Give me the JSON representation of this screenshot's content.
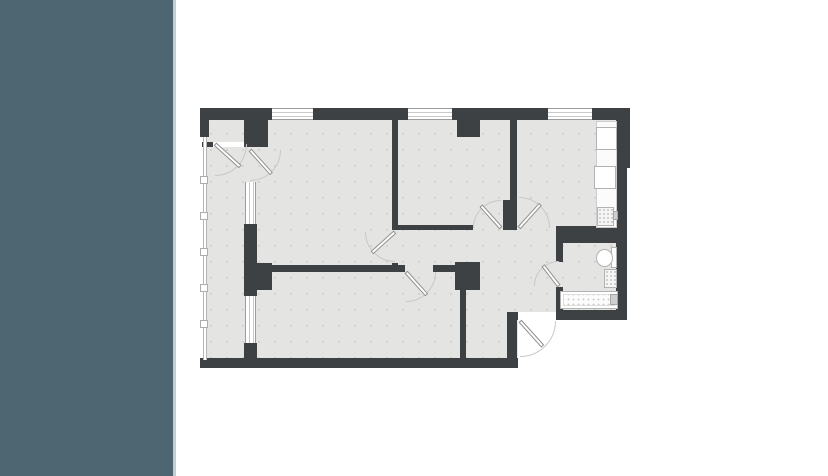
{
  "canvas": {
    "width": 828,
    "height": 476,
    "background": "#ffffff"
  },
  "left_panel": {
    "color": "#4d6671",
    "edge_color": "#c4ced2",
    "width": 173,
    "edge_width": 3
  },
  "palette": {
    "wall": "#3e4144",
    "floor": "#e4e4e3",
    "floor_dot": "#d0d0cf",
    "outside": "#ffffff",
    "window_frame": "#9c9c9c",
    "door_arc": "#c8c8c8",
    "door_leaf_border": "#8f8f8f",
    "fixture_border": "#b2b2b2"
  },
  "plan": {
    "floors": [
      {
        "n": "floor-base",
        "x": 203,
        "y": 110,
        "w": 423,
        "h": 250
      }
    ],
    "outside": [
      {
        "n": "outside-entry-area",
        "x": 518,
        "y": 320,
        "w": 114,
        "h": 50
      },
      {
        "n": "outside-right-step",
        "x": 627,
        "y": 166,
        "w": 6,
        "h": 154
      }
    ],
    "walls": [
      {
        "n": "wall-top-1",
        "x": 201,
        "y": 108,
        "w": 71,
        "h": 12
      },
      {
        "n": "wall-top-2",
        "x": 313,
        "y": 108,
        "w": 95,
        "h": 12
      },
      {
        "n": "wall-top-3",
        "x": 452,
        "y": 108,
        "w": 96,
        "h": 12
      },
      {
        "n": "wall-top-4",
        "x": 592,
        "y": 108,
        "w": 36,
        "h": 12
      },
      {
        "n": "wall-left-column",
        "x": 200,
        "y": 108,
        "w": 9,
        "h": 29
      },
      {
        "n": "wall-corner-block",
        "x": 244,
        "y": 108,
        "w": 24,
        "h": 39
      },
      {
        "n": "wall-niche-sill",
        "x": 202,
        "y": 142,
        "w": 12,
        "h": 5
      },
      {
        "n": "wall-bedroom1-column",
        "x": 457,
        "y": 120,
        "w": 23,
        "h": 17
      },
      {
        "n": "wall-right-upper",
        "x": 616,
        "y": 108,
        "w": 14,
        "h": 60
      },
      {
        "n": "wall-right-lower",
        "x": 616,
        "y": 168,
        "w": 11,
        "h": 152
      },
      {
        "n": "wall-living-bedroom1",
        "x": 392,
        "y": 120,
        "w": 6,
        "h": 110
      },
      {
        "n": "wall-living-stub",
        "x": 392,
        "y": 263,
        "w": 6,
        "h": 9
      },
      {
        "n": "wall-bedroom1-kitchen",
        "x": 510,
        "y": 120,
        "w": 7,
        "h": 82
      },
      {
        "n": "wall-kitchen-pillar",
        "x": 503,
        "y": 200,
        "w": 14,
        "h": 30
      },
      {
        "n": "wall-bedroom1-south",
        "x": 398,
        "y": 225,
        "w": 75,
        "h": 5
      },
      {
        "n": "wall-bath-north",
        "x": 556,
        "y": 226,
        "w": 62,
        "h": 17
      },
      {
        "n": "wall-bath-west-upper",
        "x": 556,
        "y": 243,
        "w": 7,
        "h": 19
      },
      {
        "n": "wall-bath-west-lower",
        "x": 556,
        "y": 287,
        "w": 7,
        "h": 25
      },
      {
        "n": "wall-bath-south",
        "x": 556,
        "y": 310,
        "w": 71,
        "h": 10
      },
      {
        "n": "wall-bedroom2-north-1",
        "x": 272,
        "y": 265,
        "w": 133,
        "h": 7
      },
      {
        "n": "wall-bedroom2-north-2",
        "x": 433,
        "y": 265,
        "w": 24,
        "h": 7
      },
      {
        "n": "wall-balcony-junction",
        "x": 244,
        "y": 263,
        "w": 28,
        "h": 27
      },
      {
        "n": "wall-hall-pillar",
        "x": 455,
        "y": 262,
        "w": 25,
        "h": 28
      },
      {
        "n": "wall-bedroom2-east",
        "x": 460,
        "y": 290,
        "w": 6,
        "h": 70
      },
      {
        "n": "wall-entry-north",
        "x": 507,
        "y": 312,
        "w": 11,
        "h": 8
      },
      {
        "n": "wall-entry-east",
        "x": 507,
        "y": 312,
        "w": 10,
        "h": 46
      },
      {
        "n": "wall-south",
        "x": 200,
        "y": 358,
        "w": 318,
        "h": 10
      },
      {
        "n": "wall-balcony-mid-1",
        "x": 244,
        "y": 224,
        "w": 13,
        "h": 39
      },
      {
        "n": "wall-balcony-mid-2",
        "x": 244,
        "y": 290,
        "w": 13,
        "h": 6
      },
      {
        "n": "wall-balcony-south",
        "x": 244,
        "y": 343,
        "w": 13,
        "h": 17
      }
    ],
    "windows": [
      {
        "n": "window-living",
        "o": "h",
        "x": 272,
        "y": 108,
        "w": 41,
        "h": 12
      },
      {
        "n": "window-bedroom-1",
        "o": "h",
        "x": 408,
        "y": 108,
        "w": 44,
        "h": 12
      },
      {
        "n": "window-kitchen",
        "o": "h",
        "x": 548,
        "y": 108,
        "w": 44,
        "h": 12
      },
      {
        "n": "window-balcony-upper",
        "o": "v",
        "x": 245,
        "y": 182,
        "w": 11,
        "h": 42
      },
      {
        "n": "window-balcony-lower",
        "o": "v",
        "x": 245,
        "y": 296,
        "w": 11,
        "h": 47
      }
    ],
    "railing": {
      "n": "balcony-railing",
      "x": 203,
      "y": 137,
      "w": 4,
      "h": 223,
      "post_size": 8,
      "posts": [
        {
          "x": 200,
          "y": 176
        },
        {
          "x": 200,
          "y": 212
        },
        {
          "x": 200,
          "y": 248
        },
        {
          "x": 200,
          "y": 284
        },
        {
          "x": 200,
          "y": 320
        }
      ]
    },
    "thresholds": [
      {
        "n": "threshold-balcony",
        "x": 213,
        "y": 142,
        "w": 31,
        "h": 5
      },
      {
        "n": "threshold-entry",
        "x": 518,
        "y": 312,
        "w": 38,
        "h": 8
      }
    ],
    "doors": [
      {
        "n": "door-balcony-niche",
        "hx": 215,
        "hy": 144,
        "len": 34,
        "angle": 42,
        "dir": "br",
        "r": 32
      },
      {
        "n": "door-living-balcony",
        "hx": 250,
        "hy": 150,
        "len": 32,
        "angle": 48,
        "dir": "br",
        "r": 31
      },
      {
        "n": "door-living",
        "hx": 395,
        "hy": 232,
        "len": 31,
        "angle": 138,
        "dir": "bl",
        "r": 30
      },
      {
        "n": "door-bedroom-2",
        "hx": 406,
        "hy": 272,
        "len": 31,
        "angle": 48,
        "dir": "br",
        "r": 30
      },
      {
        "n": "door-bedroom-1",
        "hx": 501,
        "hy": 228,
        "len": 30,
        "angle": -132,
        "dir": "tl",
        "r": 28
      },
      {
        "n": "door-kitchen",
        "hx": 519,
        "hy": 228,
        "len": 32,
        "angle": -48,
        "dir": "tr",
        "r": 31
      },
      {
        "n": "door-bathroom",
        "hx": 559,
        "hy": 286,
        "len": 26,
        "angle": -128,
        "dir": "tl",
        "r": 25
      },
      {
        "n": "door-entrance",
        "hx": 520,
        "hy": 321,
        "len": 34,
        "angle": 48,
        "dir": "br",
        "r": 36
      }
    ],
    "fixtures": [
      {
        "n": "kitchen-counter",
        "kind": "counter",
        "x": 596,
        "y": 121,
        "w": 21,
        "h": 107
      },
      {
        "n": "kitchen-appliance-upper",
        "kind": "appliance",
        "x": 596,
        "y": 127,
        "w": 21,
        "h": 23
      },
      {
        "n": "kitchen-appliance-lower",
        "kind": "appliance",
        "x": 594,
        "y": 166,
        "w": 22,
        "h": 23
      },
      {
        "n": "kitchen-sink",
        "kind": "sink",
        "x": 597,
        "y": 207,
        "w": 17,
        "h": 19
      },
      {
        "n": "kitchen-faucet",
        "kind": "knob",
        "x": 613,
        "y": 211,
        "w": 5,
        "h": 9
      },
      {
        "n": "toilet-tank",
        "kind": "tank",
        "x": 611,
        "y": 247,
        "w": 6,
        "h": 21
      },
      {
        "n": "toilet",
        "kind": "toilet",
        "x": 596,
        "y": 249,
        "w": 17,
        "h": 18
      },
      {
        "n": "bathroom-sink",
        "kind": "sink",
        "x": 604,
        "y": 269,
        "w": 13,
        "h": 19
      },
      {
        "n": "bathtub",
        "kind": "tub",
        "x": 560,
        "y": 291,
        "w": 58,
        "h": 18
      },
      {
        "n": "bathtub-faucet",
        "kind": "knob",
        "x": 610,
        "y": 294,
        "w": 8,
        "h": 11
      }
    ]
  }
}
